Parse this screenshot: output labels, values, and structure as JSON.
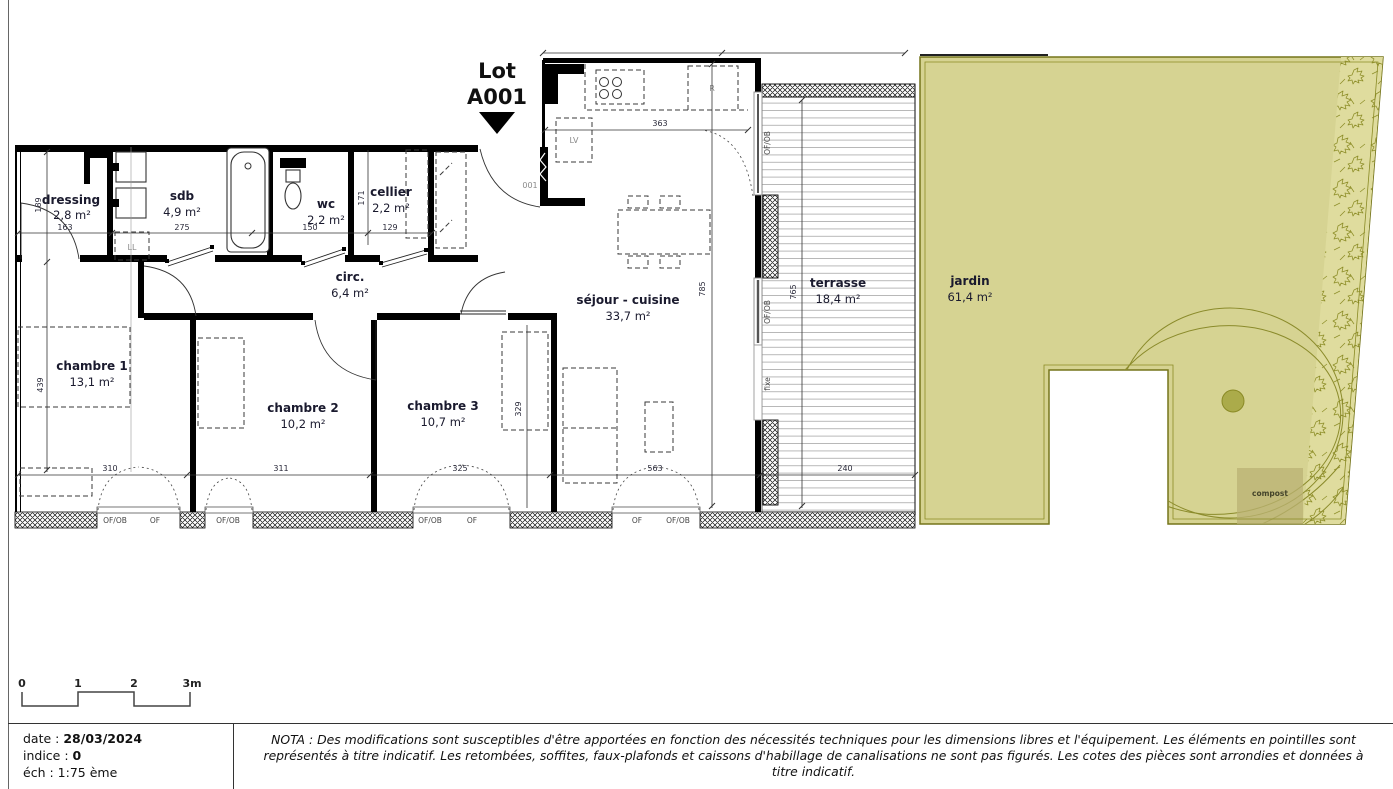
{
  "lot": {
    "label": "Lot",
    "number": "A001"
  },
  "rooms": [
    {
      "name": "dressing",
      "area": "2,8 m²"
    },
    {
      "name": "sdb",
      "area": "4,9 m²"
    },
    {
      "name": "wc",
      "area": "2,2 m²"
    },
    {
      "name": "cellier",
      "area": "2,2 m²"
    },
    {
      "name": "circ.",
      "area": "6,4 m²"
    },
    {
      "name": "chambre 1",
      "area": "13,1 m²"
    },
    {
      "name": "chambre 2",
      "area": "10,2 m²"
    },
    {
      "name": "chambre 3",
      "area": "10,7 m²"
    },
    {
      "name": "séjour - cuisine",
      "area": "33,7 m²"
    },
    {
      "name": "terrasse",
      "area": "18,4 m²"
    },
    {
      "name": "jardin",
      "area": "61,4 m²"
    }
  ],
  "dims": {
    "d163": "163",
    "d275": "275",
    "d150": "150",
    "d129": "129",
    "d171": "171",
    "d189": "189",
    "d363": "363",
    "d785": "785",
    "d765": "765",
    "d439": "439",
    "d329": "329",
    "d310": "310",
    "d311": "311",
    "d325": "325",
    "d563": "563",
    "d240": "240"
  },
  "windows_bottom": [
    "OF/OB",
    "OF",
    "OF/OB",
    "OF/OB",
    "OF",
    "OF",
    "OF/OB"
  ],
  "windows_side": [
    "OF/OB",
    "OF/OB",
    "fixe"
  ],
  "annotations": {
    "washing_machine": "LL",
    "dishwasher": "LV",
    "fridge": "R",
    "entrance_door": "001",
    "compost": "compost"
  },
  "scalebar": {
    "t0": "0",
    "t1": "1",
    "t2": "2",
    "t3": "3m"
  },
  "titleblock": {
    "date_label": "date :",
    "date_value": "28/03/2024",
    "indice_label": "indice :",
    "indice_value": "0",
    "scale_label": "éch :",
    "scale_value": "1:75 ème",
    "nota": "NOTA : Des modifications sont susceptibles d'être apportées en fonction des nécessités techniques pour les dimensions libres et l'équipement. Les éléments en pointilles sont représentés à titre indicatif. Les retombées, soffites, faux-plafonds et caissons d'habillage de canalisations ne sont pas figurés. Les cotes des pièces sont arrondies et données à titre indicatif."
  },
  "colors": {
    "jardin_fill": "#d6d392",
    "jardin_stroke": "#75751b",
    "hedge_fill": "#dfdc9e",
    "deck_line": "#b8b8b8",
    "wall": "#000000",
    "label": "#1a1a2e",
    "compost_fill": "#b9b173"
  }
}
